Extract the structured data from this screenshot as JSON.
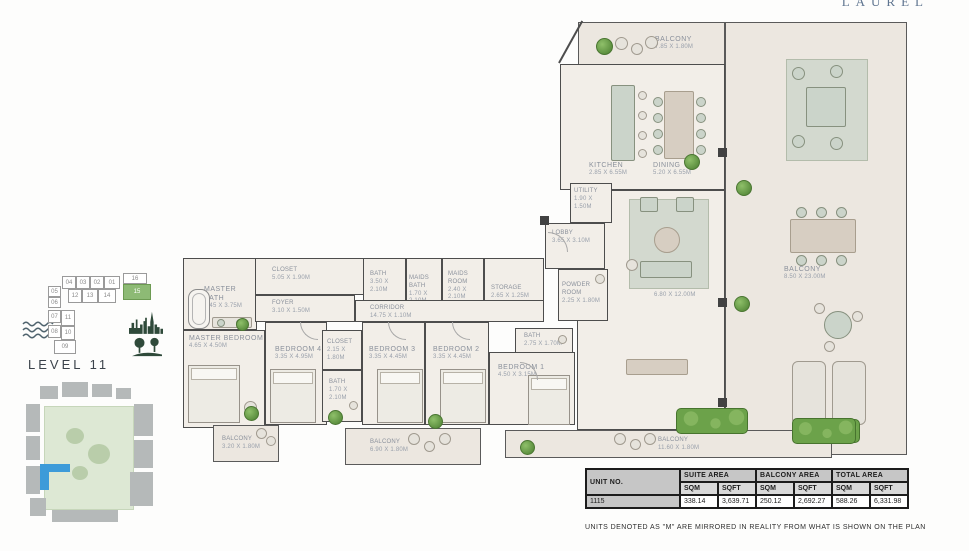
{
  "brand": "LAUREL",
  "level": {
    "label": "LEVEL 11"
  },
  "note": "UNITS DENOTED AS \"M\" ARE MIRRORED IN REALITY FROM WHAT IS SHOWN ON THE PLAN",
  "key_plan": {
    "highlighted_unit": "15",
    "units": {
      "u01": "01",
      "u02": "02",
      "u03": "03",
      "u04": "04",
      "u05": "05",
      "u06": "06",
      "u07": "07",
      "u08": "08",
      "u09": "09",
      "u10": "10",
      "u11": "11",
      "u12": "12",
      "u13": "13",
      "u14": "14",
      "u15": "15",
      "u16": "16"
    }
  },
  "rooms": [
    {
      "name": "BALCONY",
      "dims": "7.85 X 1.80M"
    },
    {
      "name": "KITCHEN",
      "dims": "2.85 X 6.55M"
    },
    {
      "name": "DINING",
      "dims": "5.20 X 6.55M"
    },
    {
      "name": "UTILITY",
      "dims": "1.90 X 1.50M"
    },
    {
      "name": "LOBBY",
      "dims": "3.65 X 3.10M"
    },
    {
      "name": "POWDER ROOM",
      "dims": "2.25 X 1.80M"
    },
    {
      "name": "LIVING",
      "dims": "6.80 X 12.00M"
    },
    {
      "name": "BALCONY",
      "dims": "8.50 X 23.00M"
    },
    {
      "name": "BALCONY",
      "dims": "11.60 X 1.80M"
    },
    {
      "name": "MASTER BATH",
      "dims": "3.45 X 3.75M"
    },
    {
      "name": "CLOSET",
      "dims": "5.05 X 1.90M"
    },
    {
      "name": "FOYER",
      "dims": "3.10 X 1.50M"
    },
    {
      "name": "BATH",
      "dims": "3.50 X 2.10M"
    },
    {
      "name": "MAIDS BATH",
      "dims": "1.70 X 2.10M"
    },
    {
      "name": "MAIDS ROOM",
      "dims": "2.40 X 2.10M"
    },
    {
      "name": "STORAGE",
      "dims": "2.65 X 1.25M"
    },
    {
      "name": "CORRIDOR",
      "dims": "14.75 X 1.10M"
    },
    {
      "name": "MASTER BEDROOM",
      "dims": "4.65 X 4.50M"
    },
    {
      "name": "BEDROOM 4",
      "dims": "3.35 X 4.95M"
    },
    {
      "name": "CLOSET",
      "dims": "2.15 X 1.80M"
    },
    {
      "name": "BATH",
      "dims": "1.70 X 2.10M"
    },
    {
      "name": "BEDROOM 3",
      "dims": "3.35 X 4.45M"
    },
    {
      "name": "BEDROOM 2",
      "dims": "3.35 X 4.45M"
    },
    {
      "name": "BATH",
      "dims": "2.75 X 1.70M"
    },
    {
      "name": "BEDROOM 1",
      "dims": "4.50 X 3.15M"
    },
    {
      "name": "BALCONY",
      "dims": "3.20 X 1.80M"
    },
    {
      "name": "BALCONY",
      "dims": "6.90 X 1.80M"
    }
  ],
  "table": {
    "col_unit": "UNIT NO.",
    "col_suite": "SUITE AREA",
    "col_balcony": "BALCONY AREA",
    "col_total": "TOTAL AREA",
    "sqm": "SQM",
    "sqft": "SQFT",
    "row": {
      "unit": "1115",
      "suite_sqm": "338.14",
      "suite_sqft": "3,639.71",
      "balcony_sqm": "250.12",
      "balcony_sqft": "2,692.27",
      "total_sqm": "588.26",
      "total_sqft": "6,331.98"
    }
  }
}
